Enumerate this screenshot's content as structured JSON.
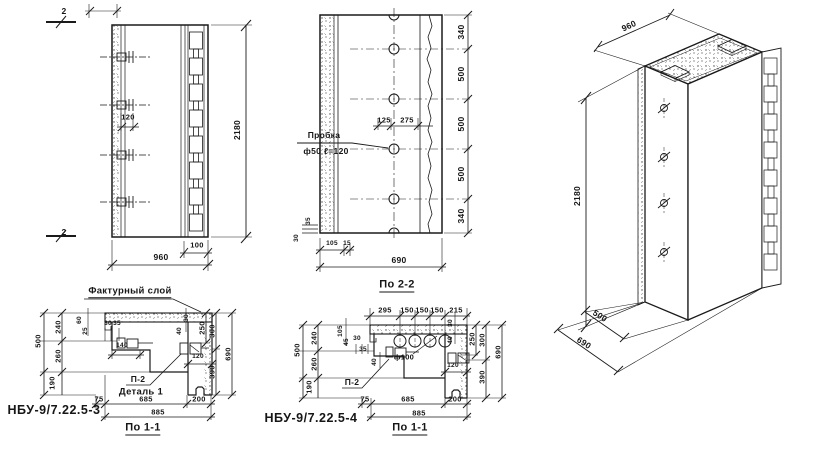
{
  "colors": {
    "paper": "#ffffff",
    "ink": "#1a1a1a"
  },
  "elevation": {
    "section_mark": "2",
    "dim_120": "120",
    "dim_height": "2180",
    "dim_100": "100",
    "dim_width": "960"
  },
  "section_2_2": {
    "note_plug_1": "Пробка",
    "note_plug_2": "ф50 ℓ=120",
    "dim_125": "125",
    "dim_275": "275",
    "right_dims": [
      "340",
      "500",
      "500",
      "500",
      "340"
    ],
    "dim_30": "30",
    "dim_35": "35",
    "dim_105": "105",
    "dim_15": "15",
    "dim_width": "690",
    "title": "По 2-2"
  },
  "iso": {
    "dim_height": "2180",
    "dim_top_width": "960",
    "dim_depth": "500",
    "dim_width": "690"
  },
  "detail_3": {
    "note_facture": "Фактурный слой",
    "dims": {
      "d500": "500",
      "d240": "240",
      "d260": "260",
      "d190": "190",
      "d60": "60",
      "d25": "25",
      "d30": "30",
      "d35": "35",
      "d140": "140",
      "d40": "40",
      "d30b": "30",
      "d120": "120",
      "d250": "250",
      "d300": "300",
      "d390": "390",
      "d690": "690",
      "d75": "75",
      "d685": "685",
      "d200": "200",
      "d885": "885"
    },
    "label_p2": "П-2",
    "label_detail": "Деталь 1",
    "title": "НБУ-9/7.22.5-3",
    "section_title": "По 1-1"
  },
  "detail_4": {
    "top_dims": [
      "295",
      "150",
      "150",
      "150",
      "215"
    ],
    "note_core": "ф100",
    "dims": {
      "d500": "500",
      "d240": "240",
      "d260": "260",
      "d190": "190",
      "d105": "105",
      "d45": "45",
      "d30": "30",
      "d35": "35",
      "d40": "40",
      "d30b": "30",
      "d40b": "40",
      "d120": "120",
      "d250": "250",
      "d300": "300",
      "d390": "390",
      "d690": "690",
      "d75": "75",
      "d685": "685",
      "d200": "200",
      "d885": "885"
    },
    "label_p2": "П-2",
    "title": "НБУ-9/7.22.5-4",
    "section_title": "По 1-1"
  }
}
